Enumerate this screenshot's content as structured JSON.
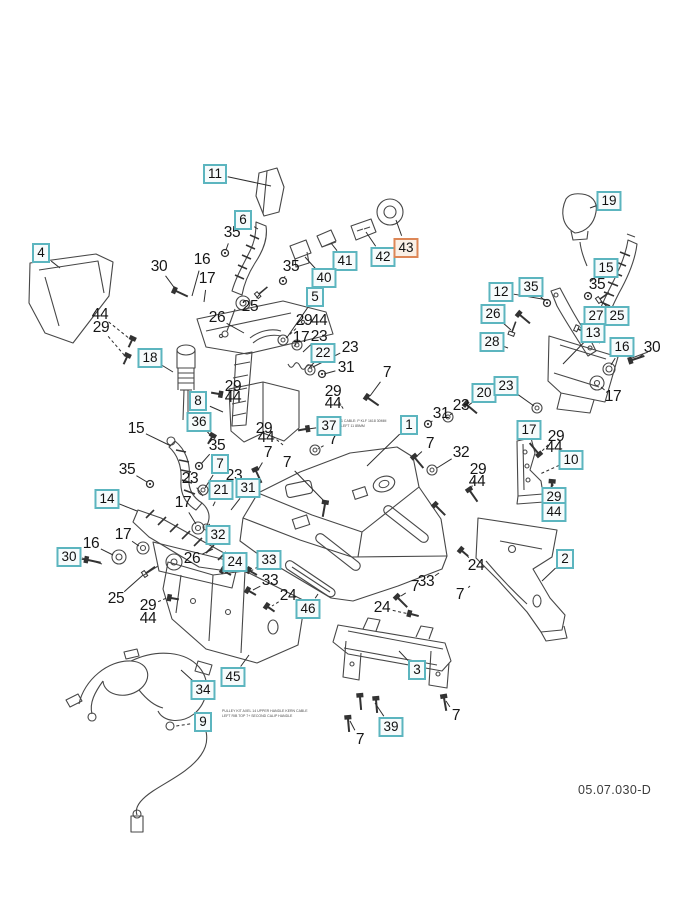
{
  "page": {
    "background": "#ffffff",
    "diagram_code": "05.07.030-D"
  },
  "styles": {
    "callout_border": "#5cb5bf",
    "callout_fill": "#f6fbfc",
    "highlight_border": "#dd8757",
    "highlight_fill": "#faf0e6",
    "label_text": "#161616",
    "line_color": "#474747"
  },
  "highlighted_part": "43",
  "callouts": [
    {
      "n": "11",
      "x": 215,
      "y": 174,
      "leader": [
        271,
        186
      ]
    },
    {
      "n": "6",
      "x": 243,
      "y": 220,
      "leader": [
        258,
        229
      ]
    },
    {
      "n": "4",
      "x": 41,
      "y": 253,
      "leader": [
        60,
        268
      ]
    },
    {
      "n": "19",
      "x": 609,
      "y": 201,
      "leader": [
        590,
        208
      ]
    },
    {
      "n": "41",
      "x": 345,
      "y": 261,
      "leader": [
        331,
        243
      ]
    },
    {
      "n": "42",
      "x": 383,
      "y": 257,
      "leader": [
        366,
        232
      ]
    },
    {
      "n": "43",
      "x": 406,
      "y": 248,
      "leader": [
        396,
        220
      ],
      "highlight": true
    },
    {
      "n": "40",
      "x": 324,
      "y": 278,
      "leader": [
        305,
        257
      ]
    },
    {
      "n": "15",
      "x": 606,
      "y": 268,
      "leader": [
        590,
        282
      ]
    },
    {
      "n": "5",
      "x": 315,
      "y": 297,
      "leader": [
        288,
        336
      ]
    },
    {
      "n": "35",
      "x": 531,
      "y": 287,
      "leader": [
        545,
        301
      ]
    },
    {
      "n": "12",
      "x": 501,
      "y": 292,
      "leader": [
        548,
        300
      ]
    },
    {
      "n": "26",
      "x": 493,
      "y": 314,
      "leader": [
        511,
        330
      ]
    },
    {
      "n": "27",
      "x": 596,
      "y": 316,
      "leader": [
        580,
        328
      ]
    },
    {
      "n": "25",
      "x": 617,
      "y": 316,
      "leader": [
        601,
        301
      ]
    },
    {
      "n": "28",
      "x": 492,
      "y": 342,
      "leader": [
        508,
        348
      ]
    },
    {
      "n": "13",
      "x": 593,
      "y": 333,
      "leader": [
        563,
        364
      ]
    },
    {
      "n": "16",
      "x": 622,
      "y": 347,
      "leader": [
        611,
        365
      ]
    },
    {
      "n": "22",
      "x": 323,
      "y": 353,
      "leader": [
        309,
        368
      ]
    },
    {
      "n": "18",
      "x": 150,
      "y": 358,
      "leader": [
        173,
        372
      ]
    },
    {
      "n": "8",
      "x": 198,
      "y": 401,
      "leader": [
        223,
        412
      ]
    },
    {
      "n": "36",
      "x": 199,
      "y": 422,
      "leader": [
        211,
        436
      ]
    },
    {
      "n": "37",
      "x": 329,
      "y": 426,
      "leader": [
        308,
        429
      ]
    },
    {
      "n": "1",
      "x": 409,
      "y": 425,
      "leader": [
        367,
        466
      ]
    },
    {
      "n": "20",
      "x": 484,
      "y": 393,
      "leader": [
        469,
        405
      ]
    },
    {
      "n": "23",
      "x": 506,
      "y": 386,
      "leader": [
        534,
        406
      ]
    },
    {
      "n": "17",
      "x": 529,
      "y": 430,
      "leader": [
        524,
        442
      ]
    },
    {
      "n": "10",
      "x": 571,
      "y": 460,
      "leader": [
        540,
        474
      ],
      "dash": true
    },
    {
      "n": "29",
      "x": 554,
      "y": 497,
      "leader": [
        553,
        486
      ]
    },
    {
      "n": "44",
      "x": 554,
      "y": 512
    },
    {
      "n": "7",
      "x": 220,
      "y": 464,
      "leader": [
        205,
        488
      ]
    },
    {
      "n": "21",
      "x": 221,
      "y": 490,
      "leader": [
        213,
        506
      ]
    },
    {
      "n": "31",
      "x": 248,
      "y": 488,
      "leader": [
        231,
        510
      ]
    },
    {
      "n": "14",
      "x": 107,
      "y": 499,
      "leader": [
        137,
        511
      ]
    },
    {
      "n": "32",
      "x": 218,
      "y": 535,
      "leader": [
        209,
        524
      ]
    },
    {
      "n": "30",
      "x": 69,
      "y": 557,
      "leader": [
        86,
        560
      ]
    },
    {
      "n": "24",
      "x": 235,
      "y": 562,
      "leader": [
        224,
        571
      ],
      "dash": true
    },
    {
      "n": "33",
      "x": 269,
      "y": 560,
      "leader": [
        251,
        571
      ],
      "dash": true
    },
    {
      "n": "46",
      "x": 308,
      "y": 609,
      "leader": [
        318,
        594
      ]
    },
    {
      "n": "2",
      "x": 565,
      "y": 559,
      "leader": [
        542,
        581
      ]
    },
    {
      "n": "45",
      "x": 233,
      "y": 677,
      "leader": [
        249,
        655
      ]
    },
    {
      "n": "34",
      "x": 203,
      "y": 690,
      "leader": [
        181,
        670
      ]
    },
    {
      "n": "9",
      "x": 203,
      "y": 722,
      "leader": [
        176,
        726
      ],
      "dash": true
    },
    {
      "n": "3",
      "x": 417,
      "y": 670,
      "leader": [
        399,
        651
      ]
    },
    {
      "n": "39",
      "x": 391,
      "y": 727,
      "leader": [
        375,
        703
      ]
    }
  ],
  "labels": [
    {
      "n": "35",
      "x": 232,
      "y": 233,
      "leader": [
        226,
        250
      ]
    },
    {
      "n": "30",
      "x": 159,
      "y": 267,
      "leader": [
        176,
        290
      ]
    },
    {
      "n": "16",
      "x": 202,
      "y": 260,
      "leader": [
        192,
        296
      ]
    },
    {
      "n": "17",
      "x": 207,
      "y": 279,
      "leader": [
        204,
        302
      ]
    },
    {
      "n": "26",
      "x": 217,
      "y": 318,
      "leader": [
        244,
        333
      ]
    },
    {
      "n": "25",
      "x": 250,
      "y": 307,
      "leader": [
        259,
        295
      ]
    },
    {
      "n": "35",
      "x": 291,
      "y": 267,
      "leader": [
        284,
        278
      ]
    },
    {
      "n": "44",
      "x": 100,
      "y": 315,
      "leader": [
        130,
        339
      ],
      "dash": true
    },
    {
      "n": "29",
      "x": 101,
      "y": 328,
      "leader": [
        125,
        356
      ],
      "dash": true
    },
    {
      "n": "29",
      "x": 304,
      "y": 321,
      "leader": [
        286,
        338
      ],
      "dash": true
    },
    {
      "n": "44",
      "x": 319,
      "y": 321
    },
    {
      "n": "17",
      "x": 301,
      "y": 338,
      "leader": [
        296,
        344
      ]
    },
    {
      "n": "23",
      "x": 319,
      "y": 337,
      "leader": [
        303,
        352
      ]
    },
    {
      "n": "23",
      "x": 350,
      "y": 348,
      "leader": [
        313,
        367
      ]
    },
    {
      "n": "31",
      "x": 346,
      "y": 368,
      "leader": [
        324,
        374
      ]
    },
    {
      "n": "7",
      "x": 387,
      "y": 373,
      "leader": [
        370,
        396
      ]
    },
    {
      "n": "29",
      "x": 333,
      "y": 392,
      "leader": [
        344,
        410
      ],
      "dash": true
    },
    {
      "n": "44",
      "x": 333,
      "y": 404
    },
    {
      "n": "35",
      "x": 597,
      "y": 285,
      "leader": [
        589,
        294
      ]
    },
    {
      "n": "30",
      "x": 652,
      "y": 348,
      "leader": [
        638,
        358
      ]
    },
    {
      "n": "17",
      "x": 613,
      "y": 397,
      "leader": [
        601,
        387
      ]
    },
    {
      "n": "29",
      "x": 556,
      "y": 437,
      "leader": [
        541,
        452
      ],
      "dash": true
    },
    {
      "n": "44",
      "x": 554,
      "y": 448
    },
    {
      "n": "23",
      "x": 461,
      "y": 406,
      "leader": [
        450,
        415
      ]
    },
    {
      "n": "31",
      "x": 441,
      "y": 414,
      "leader": [
        431,
        422
      ]
    },
    {
      "n": "7",
      "x": 430,
      "y": 444,
      "leader": [
        417,
        456
      ]
    },
    {
      "n": "32",
      "x": 461,
      "y": 453,
      "leader": [
        437,
        468
      ]
    },
    {
      "n": "29",
      "x": 478,
      "y": 470,
      "leader": [
        471,
        489
      ],
      "dash": true
    },
    {
      "n": "44",
      "x": 477,
      "y": 482
    },
    {
      "n": "15",
      "x": 136,
      "y": 429,
      "leader": [
        171,
        446
      ]
    },
    {
      "n": "35",
      "x": 217,
      "y": 446,
      "leader": [
        201,
        464
      ]
    },
    {
      "n": "29",
      "x": 264,
      "y": 429,
      "leader": [
        283,
        445
      ],
      "dash": true
    },
    {
      "n": "44",
      "x": 266,
      "y": 438
    },
    {
      "n": "7",
      "x": 333,
      "y": 440,
      "leader": [
        318,
        449
      ],
      "dash": true
    },
    {
      "n": "7",
      "x": 268,
      "y": 453,
      "leader": [
        258,
        470
      ]
    },
    {
      "n": "7",
      "x": 287,
      "y": 463,
      "leader": [
        325,
        502
      ]
    },
    {
      "n": "29",
      "x": 233,
      "y": 387,
      "leader": [
        221,
        393
      ],
      "dash": true
    },
    {
      "n": "44",
      "x": 233,
      "y": 398
    },
    {
      "n": "35",
      "x": 127,
      "y": 470,
      "leader": [
        147,
        482
      ]
    },
    {
      "n": "23",
      "x": 190,
      "y": 479,
      "leader": [
        203,
        496
      ]
    },
    {
      "n": "23",
      "x": 234,
      "y": 476,
      "leader": [
        222,
        493
      ]
    },
    {
      "n": "17",
      "x": 183,
      "y": 503,
      "leader": [
        196,
        524
      ]
    },
    {
      "n": "17",
      "x": 123,
      "y": 535,
      "leader": [
        139,
        546
      ]
    },
    {
      "n": "16",
      "x": 91,
      "y": 544,
      "leader": [
        113,
        555
      ]
    },
    {
      "n": "26",
      "x": 192,
      "y": 559,
      "leader": [
        213,
        549
      ]
    },
    {
      "n": "25",
      "x": 116,
      "y": 599,
      "leader": [
        143,
        575
      ]
    },
    {
      "n": "29",
      "x": 148,
      "y": 606,
      "leader": [
        169,
        597
      ],
      "dash": true
    },
    {
      "n": "44",
      "x": 148,
      "y": 619
    },
    {
      "n": "33",
      "x": 270,
      "y": 581,
      "leader": [
        253,
        590
      ]
    },
    {
      "n": "24",
      "x": 288,
      "y": 596,
      "leader": [
        272,
        606
      ],
      "dash": true
    },
    {
      "n": "24",
      "x": 476,
      "y": 566,
      "leader": [
        464,
        552
      ],
      "dash": true
    },
    {
      "n": "33",
      "x": 426,
      "y": 582,
      "leader": [
        439,
        573
      ]
    },
    {
      "n": "7",
      "x": 415,
      "y": 587,
      "leader": [
        401,
        596
      ]
    },
    {
      "n": "7",
      "x": 460,
      "y": 595,
      "leader": [
        470,
        586
      ]
    },
    {
      "n": "24",
      "x": 382,
      "y": 608,
      "leader": [
        409,
        614
      ],
      "dash": true
    },
    {
      "n": "7",
      "x": 456,
      "y": 716,
      "leader": [
        446,
        701
      ]
    },
    {
      "n": "7",
      "x": 360,
      "y": 740,
      "leader": [
        350,
        721
      ]
    }
  ],
  "fine_print": [
    {
      "x": 341,
      "y": 419,
      "lines": [
        "1 CABLE: P KLF 1618 30MM",
        "LEFT 11 85MM"
      ]
    },
    {
      "x": 222,
      "y": 709,
      "lines": [
        "PULLEY KIT AXEL 14 UPPER HANDLE KERN CABLE",
        "LEFT RIB TOP 7+ SECOND CALIP HANDLE"
      ]
    }
  ]
}
